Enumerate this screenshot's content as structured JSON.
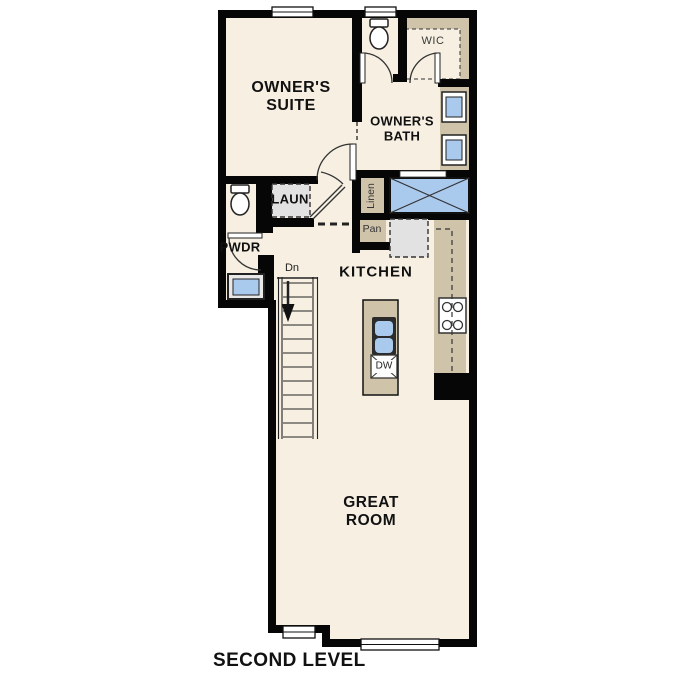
{
  "title": "SECOND LEVEL",
  "floor_plan": {
    "rooms": {
      "owners_suite": {
        "line1": "OWNER'S",
        "line2": "SUITE"
      },
      "owners_bath": {
        "line1": "OWNER'S",
        "line2": "BATH"
      },
      "wic": {
        "label": "WIC"
      },
      "laundry": {
        "label": "LAUN"
      },
      "powder": {
        "label": "PWDR"
      },
      "linen": {
        "label": "Linen"
      },
      "pantry": {
        "label": "Pan"
      },
      "kitchen": {
        "label": "KITCHEN"
      },
      "great_room": {
        "line1": "GREAT",
        "line2": "ROOM"
      },
      "stairs": {
        "label": "Dn"
      },
      "dishwasher": {
        "label": "DW"
      }
    },
    "fixtures": [
      "toilet-icon",
      "shower-icon",
      "double-vanity-sink-icon",
      "powder-sink-icon",
      "island-sink-icon",
      "dishwasher-icon",
      "range-icon",
      "refrigerator-icon",
      "washer-dryer-icon",
      "wic-shelving",
      "stairs-down-icon",
      "window-icon",
      "door-swing-icon"
    ],
    "colors": {
      "wall": "#000000",
      "floor": "#f6efe2",
      "cabinet_tan": "#cfc3aa",
      "fixture_blue": "#a9c9ed",
      "appliance_gray": "#e2e2e2",
      "background": "#ffffff",
      "text": "#111111"
    }
  }
}
